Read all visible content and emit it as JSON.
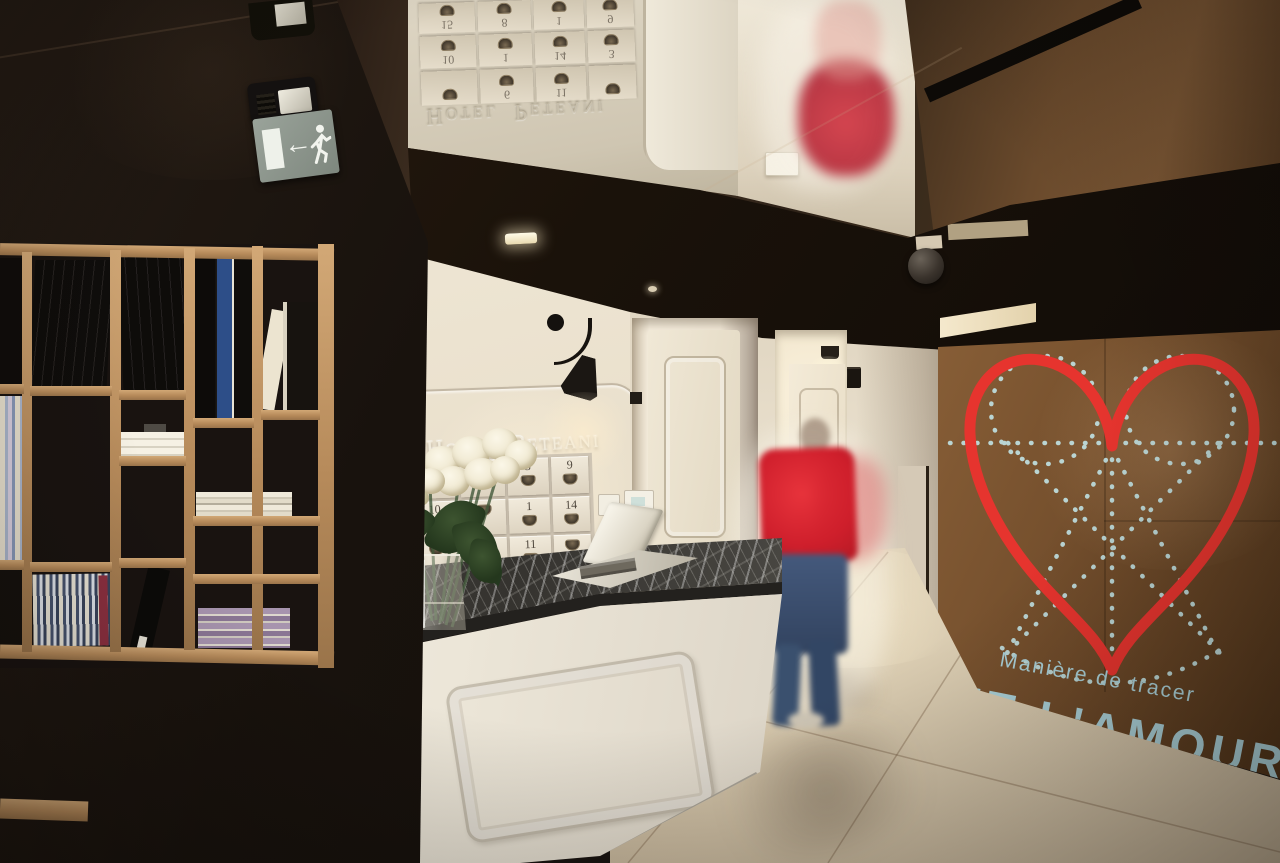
{
  "title": "Hotel Peteani reception lobby photograph",
  "reception": {
    "wall_sign": "Hotel Peteani",
    "key_cabinet": {
      "rows": [
        [
          "",
          "",
          "3",
          "9"
        ],
        [
          "10",
          "",
          "1",
          "14"
        ],
        [
          "",
          "6",
          "11",
          ""
        ]
      ]
    }
  },
  "mirror": {
    "wall_sign": "Hotel Peteani",
    "key_cabinet_rows": [
      [
        "",
        "6",
        "11",
        ""
      ],
      [
        "10",
        "1",
        "14",
        "3"
      ],
      [
        "15",
        "8",
        "1",
        "9"
      ]
    ]
  },
  "mural": {
    "caption_small": "Manière de tracer",
    "caption_large": "ET L'AMOUR",
    "heart_color": "#e6342e",
    "dotted_color": "#bedcdc",
    "caption_color": "#a9cfd6",
    "wall_color": "#6a4a2c"
  },
  "exit_sign": {
    "pictogram": "running man",
    "arrow_glyph": "←",
    "background_color": "#8e978e"
  },
  "palette": {
    "black_wall": "#18120e",
    "wood_shelf": "#b98c5e",
    "white_wall": "#efe7d7",
    "marble_top": "#3f3e3a",
    "floor": "#ddd0b8",
    "person_shirt": "#d5242e",
    "person_jeans": "#3c5374"
  }
}
